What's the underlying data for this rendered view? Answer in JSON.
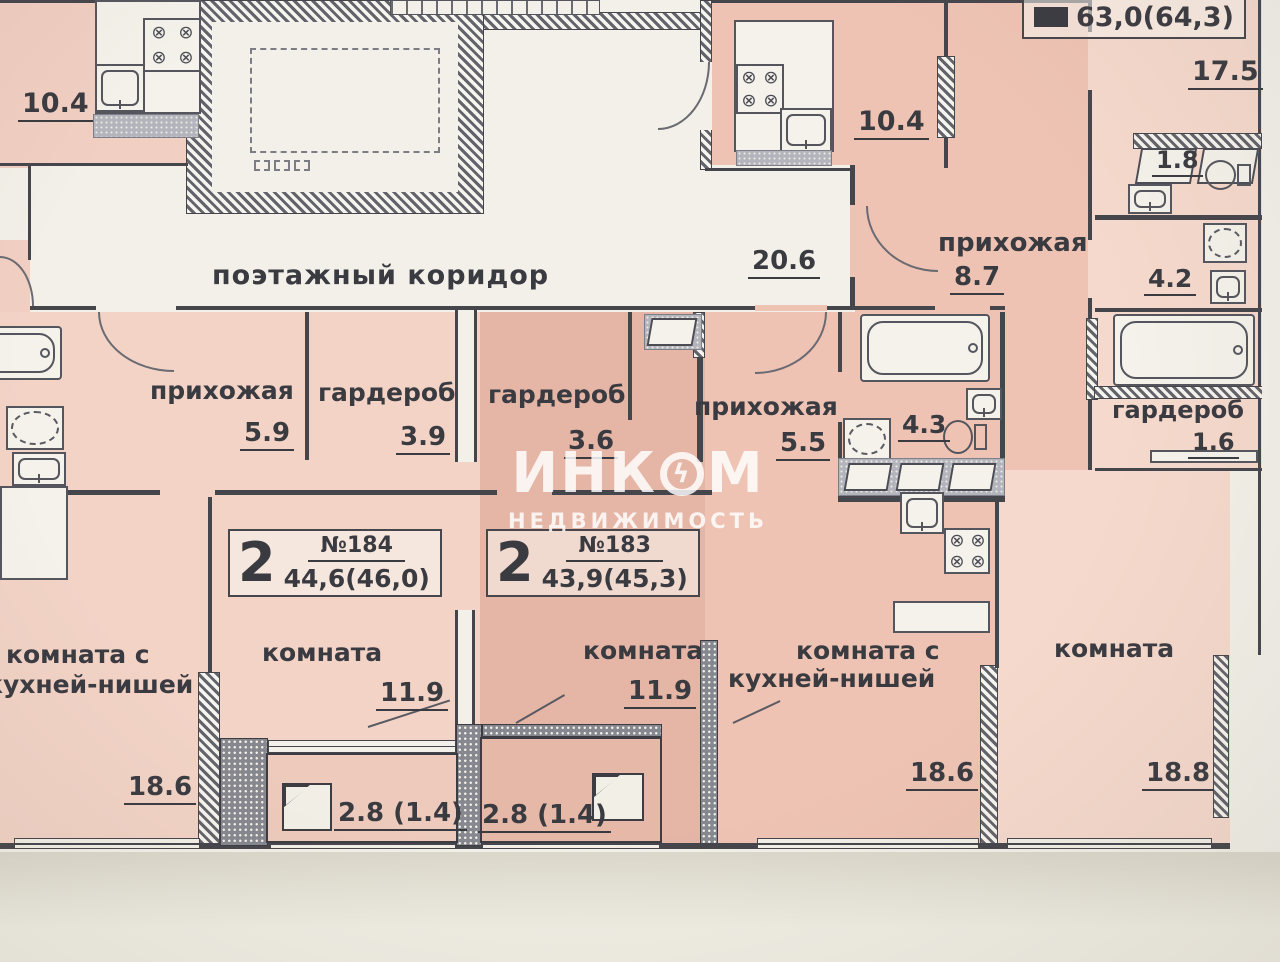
{
  "plan": {
    "corridor": {
      "name": "поэтажный коридор",
      "area": "20.6"
    },
    "badges": {
      "apt184": {
        "rooms": "2",
        "number": "№184",
        "area": "44,6(46,0)"
      },
      "apt183": {
        "rooms": "2",
        "number": "№183",
        "area": "43,9(45,3)"
      },
      "apt_top": {
        "area": "63,0(64,3)"
      }
    },
    "rooms": {
      "kitchen_left": {
        "area": "10.4"
      },
      "kitchen_right": {
        "area": "10.4"
      },
      "room_17_5": {
        "area": "17.5"
      },
      "wc_1_8": {
        "area": "1.8"
      },
      "hall_8_7": {
        "name": "прихожая",
        "area": "8.7"
      },
      "bath_4_2": {
        "area": "4.2"
      },
      "hall_5_9": {
        "name": "прихожая",
        "area": "5.9"
      },
      "ward_3_9": {
        "name": "гардероб",
        "area": "3.9"
      },
      "ward_3_6": {
        "name": "гардероб",
        "area": "3.6"
      },
      "hall_5_5": {
        "name": "прихожая",
        "area": "5.5"
      },
      "bath_4_3": {
        "area": "4.3"
      },
      "ward_1_6": {
        "name": "гардероб",
        "area": "1.6"
      },
      "living_left": {
        "name_line1": "комната с",
        "name_line2": "кухней-нишей",
        "area": "18.6"
      },
      "room_a": {
        "name": "комната",
        "area": "11.9"
      },
      "room_b": {
        "name": "комната",
        "area": "11.9"
      },
      "living_right": {
        "name_line1": "комната с",
        "name_line2": "кухней-нишей",
        "area": "18.6"
      },
      "room_c": {
        "name": "комната",
        "area": "18.8"
      },
      "balcony_a": {
        "area": "2.8 (1.4)"
      },
      "balcony_b": {
        "area": "2.8 (1.4)"
      }
    },
    "watermark": {
      "part1": "ИНК",
      "symbol": "ϟ",
      "part2": "М",
      "line2": "НЕДВИЖИМОСТЬ"
    }
  }
}
